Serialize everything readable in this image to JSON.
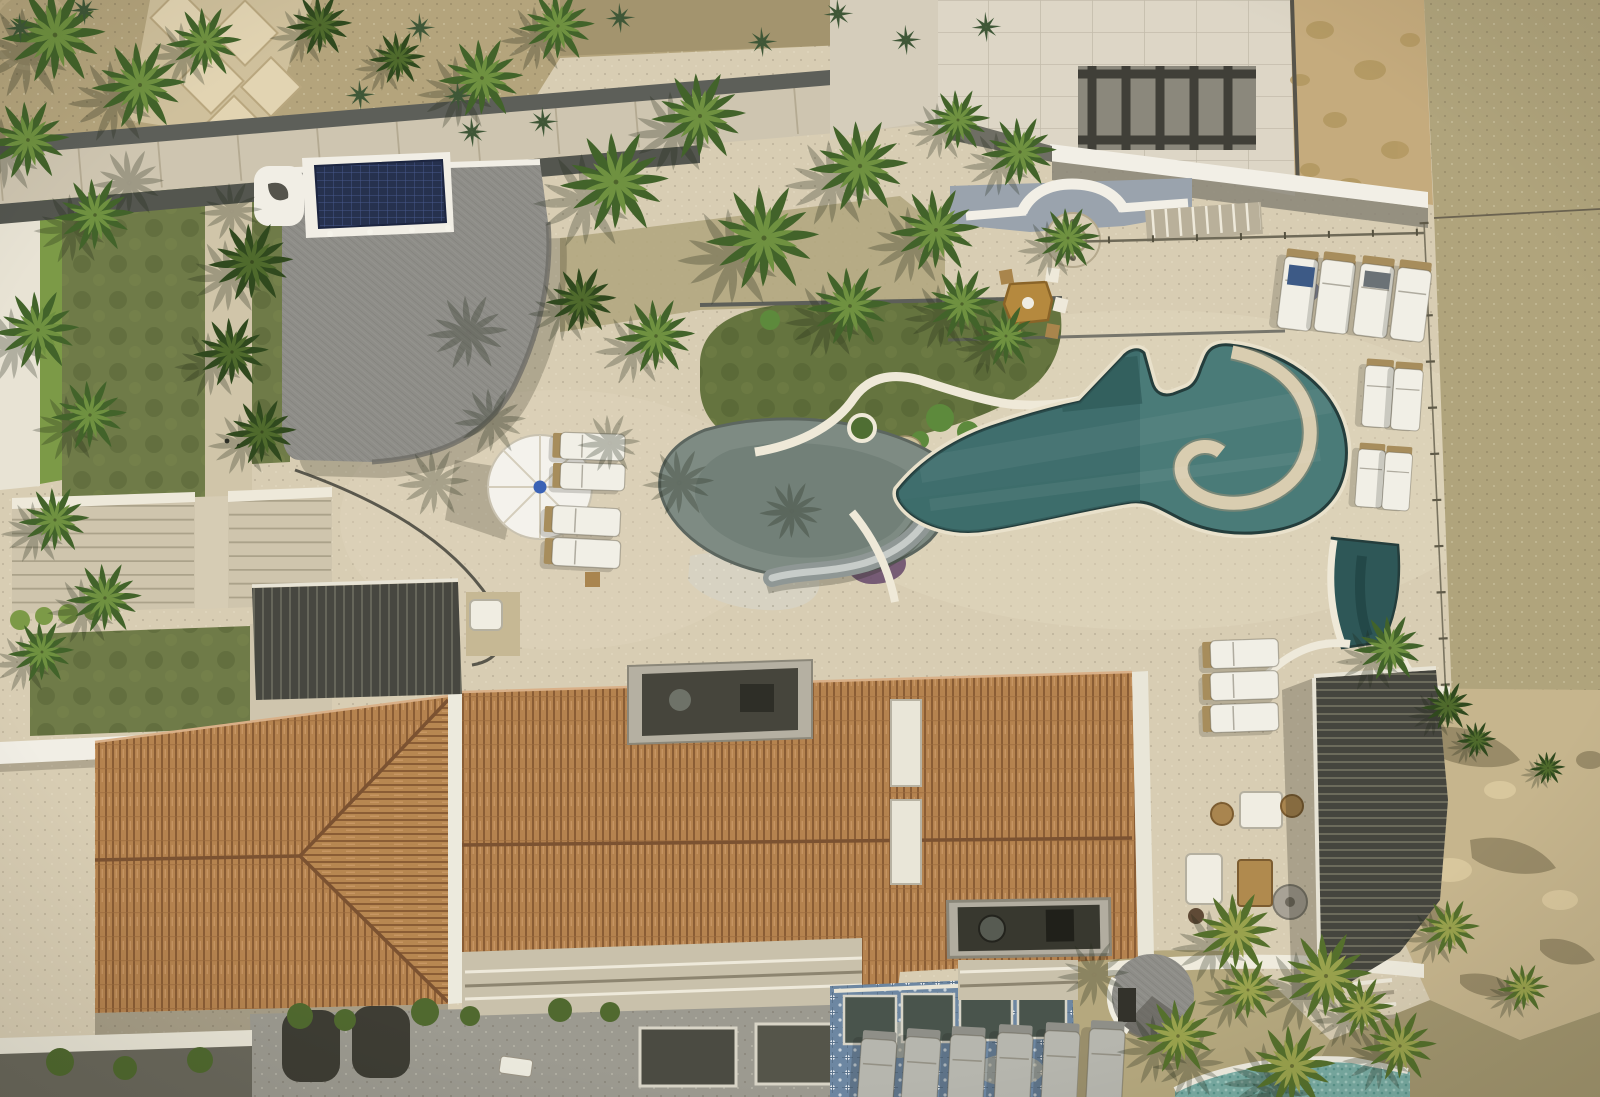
{
  "meta": {
    "type": "aerial-drone-photograph",
    "subject": "beachfront luxury villa seen straight down from above",
    "setting": "desert-coast estate with pools, palapa, terracotta roofs, palms and sandy beach"
  },
  "palette": {
    "travertine": "#d8cdb3",
    "travertine_shaded": "#c3b89d",
    "gravel": "#b4a47c",
    "cobble": "#a3946e",
    "stone_path": "#e0d2af",
    "beach_sand": "#b0a47c",
    "rock": "#c6b58d",
    "rock_shadow": "#8a7d5c",
    "lawn": "#6f7b48",
    "lawn_dark": "#5d6b3d",
    "hedge": "#7c9a47",
    "thatch": "#8e8d88",
    "thatch_dark": "#6e6d67",
    "solar_panel": "#26314e",
    "white_structure": "#f1eee5",
    "walkway": "#cec5b0",
    "dark_eave": "#5d5f59",
    "terracotta": "#b5834f",
    "terracotta_line": "#8a5d35",
    "pool_water": "#4a7b78",
    "pool_water_deep": "#33605f",
    "coping_dark": "#243d3c",
    "coping_light": "#e9e1cb",
    "plunge_pool": "#2e5757",
    "splash_pad": "#7e8b83",
    "slide_gray": "#8f9795",
    "pergola_dark": "#474740",
    "lower_terrace": "#9c9a90",
    "talavera_blue": "#6d87a2",
    "mosaic_pool": "#79aca3",
    "umbrella_white": "#f4f2ec",
    "umbrella_dot": "#3a62b5",
    "cushion_white": "#f2f0e8",
    "wood": "#a98a55",
    "lounger_gray": "#b6b6ae"
  },
  "objects": {
    "main_pool": "freeform swimming pool with lazy-river loop island",
    "water_slide": "gray curved water slide into splash pool",
    "splash_pad": "shallow grey-green kids pool",
    "plunge_pool": "dark narrow plunge pool near beach",
    "beach_pool": "turquoise mosaic pool at lower beach level",
    "palapa": "large grey thatched palapa roof with rooftop solar array",
    "umbrella": "white octagonal patio umbrella with blue finial",
    "white_loungers": 15,
    "gray_loungers": 6,
    "dining_table": "octagonal carved wood table with chairs",
    "fountain": "semicircular wall fountain in courtyard",
    "tile_roofs": "terracotta barrel-tile hip roofs of main villa",
    "white_roofs": "flat white parapet roofs at lower left",
    "pergolas": 3,
    "lawns": "clipped lawn panels with central stone path and wide garden stairs",
    "beach": "sand with rope fence and rock outcrop",
    "palm_trees": "dozens of fan palms throughout the gardens"
  },
  "palms": [
    [
      55,
      35,
      1.1
    ],
    [
      140,
      85,
      1.0
    ],
    [
      28,
      140,
      0.9
    ],
    [
      205,
      42,
      0.8
    ],
    [
      95,
      215,
      0.85
    ],
    [
      38,
      330,
      0.9
    ],
    [
      90,
      415,
      0.8
    ],
    [
      55,
      520,
      0.75
    ],
    [
      105,
      598,
      0.8
    ],
    [
      42,
      652,
      0.7
    ],
    [
      320,
      25,
      0.7,
      "d"
    ],
    [
      398,
      58,
      0.6,
      "d"
    ],
    [
      482,
      78,
      0.9
    ],
    [
      558,
      26,
      0.8
    ],
    [
      616,
      182,
      1.15
    ],
    [
      700,
      116,
      1.0
    ],
    [
      764,
      238,
      1.2
    ],
    [
      860,
      166,
      1.05
    ],
    [
      936,
      230,
      0.95
    ],
    [
      850,
      306,
      0.9
    ],
    [
      962,
      304,
      0.8
    ],
    [
      582,
      300,
      0.75,
      "d"
    ],
    [
      656,
      336,
      0.85
    ],
    [
      1006,
      336,
      0.7
    ],
    [
      1020,
      152,
      0.8
    ],
    [
      1068,
      238,
      0.7
    ],
    [
      958,
      120,
      0.7
    ],
    [
      252,
      262,
      0.9,
      "d"
    ],
    [
      232,
      352,
      0.8,
      "d"
    ],
    [
      262,
      432,
      0.75,
      "d"
    ],
    [
      1390,
      648,
      0.75
    ],
    [
      1448,
      706,
      0.55,
      "d"
    ],
    [
      1236,
      932,
      0.9,
      "y"
    ],
    [
      1326,
      976,
      1.0,
      "y"
    ],
    [
      1178,
      1036,
      0.85,
      "y"
    ],
    [
      1292,
      1066,
      0.95,
      "y"
    ],
    [
      1400,
      1046,
      0.8,
      "y"
    ],
    [
      1450,
      928,
      0.65,
      "y"
    ],
    [
      1524,
      988,
      0.55,
      "y"
    ],
    [
      1248,
      990,
      0.7,
      "y"
    ],
    [
      1362,
      1008,
      0.7,
      "y"
    ],
    [
      1477,
      740,
      0.42,
      "d"
    ],
    [
      1548,
      768,
      0.38,
      "d"
    ]
  ],
  "shadow_palms": [
    [
      492,
      318,
      0.9
    ],
    [
      512,
      408,
      0.8
    ],
    [
      700,
      470,
      0.8
    ],
    [
      810,
      500,
      0.7
    ],
    [
      455,
      470,
      0.8
    ],
    [
      628,
      432,
      0.7
    ],
    [
      1115,
      962,
      0.8
    ],
    [
      1210,
      1052,
      0.8
    ],
    [
      1302,
      1082,
      0.8
    ],
    [
      150,
      170,
      0.8
    ],
    [
      250,
      200,
      0.7
    ]
  ],
  "agaves": [
    [
      420,
      28
    ],
    [
      458,
      96
    ],
    [
      620,
      18
    ],
    [
      762,
      42
    ],
    [
      838,
      14
    ],
    [
      906,
      40
    ],
    [
      986,
      27
    ],
    [
      472,
      132
    ],
    [
      543,
      122
    ],
    [
      20,
      28
    ],
    [
      84,
      10
    ],
    [
      360,
      95
    ]
  ],
  "loungers": [
    {
      "x": 1286,
      "y": 250,
      "r": 7,
      "t": "w",
      "s": 1
    },
    {
      "x": 1323,
      "y": 253,
      "r": 7,
      "t": "w",
      "s": 1
    },
    {
      "x": 1362,
      "y": 257,
      "r": 7,
      "t": "w",
      "s": 1
    },
    {
      "x": 1399,
      "y": 261,
      "r": 7,
      "t": "w",
      "s": 1
    },
    {
      "x": 1366,
      "y": 360,
      "r": 4,
      "t": "w",
      "s": 0.85
    },
    {
      "x": 1395,
      "y": 363,
      "r": 4,
      "t": "w",
      "s": 0.85
    },
    {
      "x": 1359,
      "y": 444,
      "r": 4,
      "t": "w",
      "s": 0.8
    },
    {
      "x": 1386,
      "y": 447,
      "r": 4,
      "t": "w",
      "s": 0.8
    },
    {
      "x": 1205,
      "y": 641,
      "r": -2,
      "t": "wh",
      "s": 1
    },
    {
      "x": 1205,
      "y": 673,
      "r": -2,
      "t": "wh",
      "s": 1
    },
    {
      "x": 1205,
      "y": 705,
      "r": -2,
      "t": "wh",
      "s": 1
    },
    {
      "x": 556,
      "y": 432,
      "r": 2,
      "t": "wh",
      "s": 0.95
    },
    {
      "x": 556,
      "y": 462,
      "r": 2,
      "t": "wh",
      "s": 0.95
    },
    {
      "x": 548,
      "y": 505,
      "r": 3,
      "t": "wh",
      "s": 1
    },
    {
      "x": 548,
      "y": 537,
      "r": 3,
      "t": "wh",
      "s": 1
    },
    {
      "x": 862,
      "y": 1032,
      "r": 4,
      "t": "g",
      "s": 1.05
    },
    {
      "x": 906,
      "y": 1030,
      "r": 4,
      "t": "g",
      "s": 1.05
    },
    {
      "x": 951,
      "y": 1028,
      "r": 3,
      "t": "g",
      "s": 1.05
    },
    {
      "x": 998,
      "y": 1026,
      "r": 3,
      "t": "g",
      "s": 1.05
    },
    {
      "x": 1045,
      "y": 1024,
      "r": 3,
      "t": "g",
      "s": 1.05
    },
    {
      "x": 1090,
      "y": 1022,
      "r": 3,
      "t": "g",
      "s": 1.05
    }
  ]
}
